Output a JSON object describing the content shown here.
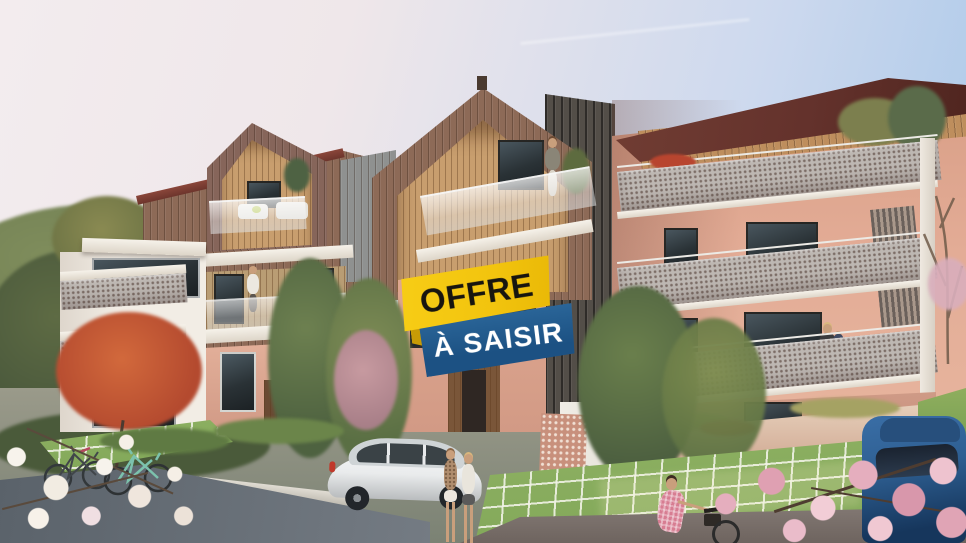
{
  "badge": {
    "line1": "OFFRE",
    "line2": "À SAISIR",
    "colors": {
      "line1_bg": "#F2C40E",
      "line1_text": "#17150F",
      "line2_bg": "#1C5183",
      "line2_text": "#FFFFFF",
      "fold": "#C79B06"
    }
  },
  "colors": {
    "sky_left": "#F3ECEE",
    "sky_right": "#A6C6E8",
    "bronze_cladding": "#8D6A57",
    "wood_slats": "#C89E6E",
    "roof_maroon": "#64322C",
    "copper_band": "#BE8E5D",
    "salmon_wall": "#E3AC96",
    "dark_slat_wall": "#534E48",
    "perforated_railing": "#BDB7B2",
    "grass_paver": "#7FA657",
    "path_asphalt": "#5A626A",
    "hill_green": "#6F7D52",
    "blossom_white": "#F7F3EC",
    "blossom_pink": "#E5AEBE",
    "car_white": "#E9EBEC",
    "car_blue": "#2E5F92"
  },
  "scene": {
    "type": "real-estate architectural render",
    "buildings": [
      "left-residence-gabled-bronze",
      "center-residence-large-gable",
      "right-residence-maroon-roof-perforated-balconies"
    ],
    "foreground": [
      "grass-paver-parking",
      "white-suv",
      "blue-car",
      "two-bicycles",
      "two-women-walking",
      "woman-cycling-pink-dress",
      "white-blossom-branch",
      "pink-blossom-tree",
      "red-leaf-tree"
    ],
    "background": [
      "green-hill",
      "village-roofs",
      "autumn-trees",
      "bare-tree"
    ],
    "residents": [
      "woman-on-gable-balcony",
      "person-on-left-balcony",
      "mother-and-child-on-balcony"
    ]
  }
}
